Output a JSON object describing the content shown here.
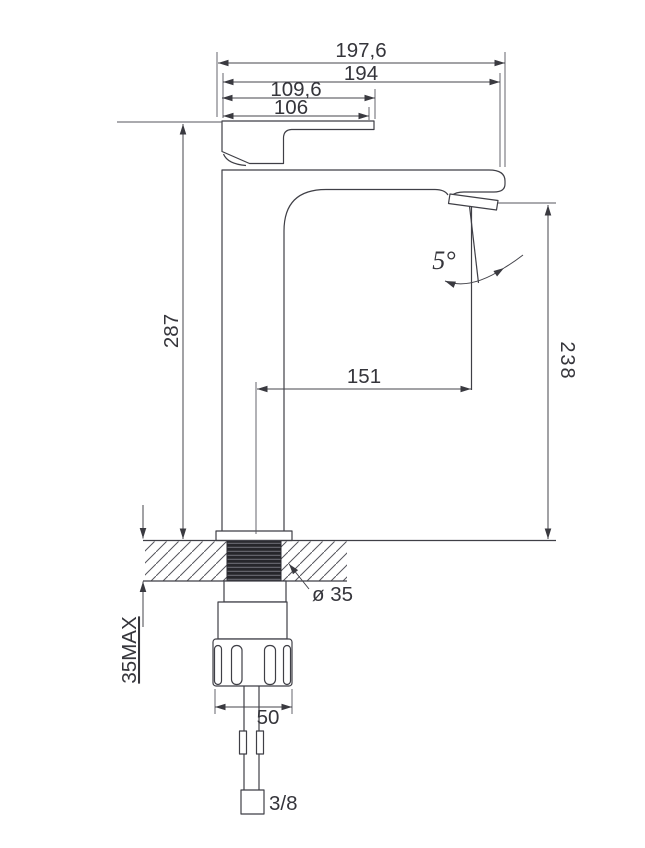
{
  "drawing": {
    "title": "single-lever-basin-faucet-dimension-drawing",
    "colors": {
      "line": "#3f3f46",
      "text": "#35353b",
      "thread_fill": "#26262b",
      "background": "#ffffff"
    },
    "dimensions": {
      "overall_depth": "197,6",
      "body_depth": "194",
      "handle_overhang": "109,6",
      "handle_length": "106",
      "total_height_above_deck": "287",
      "spout_outlet_height": "238",
      "spout_reach": "151",
      "deck_thickness_max": "35MAX",
      "mounting_hole_diameter": "ø 35",
      "stream_angle": "5°",
      "mounting_nut_width": "50",
      "supply_hose_thread": "3/8"
    }
  }
}
